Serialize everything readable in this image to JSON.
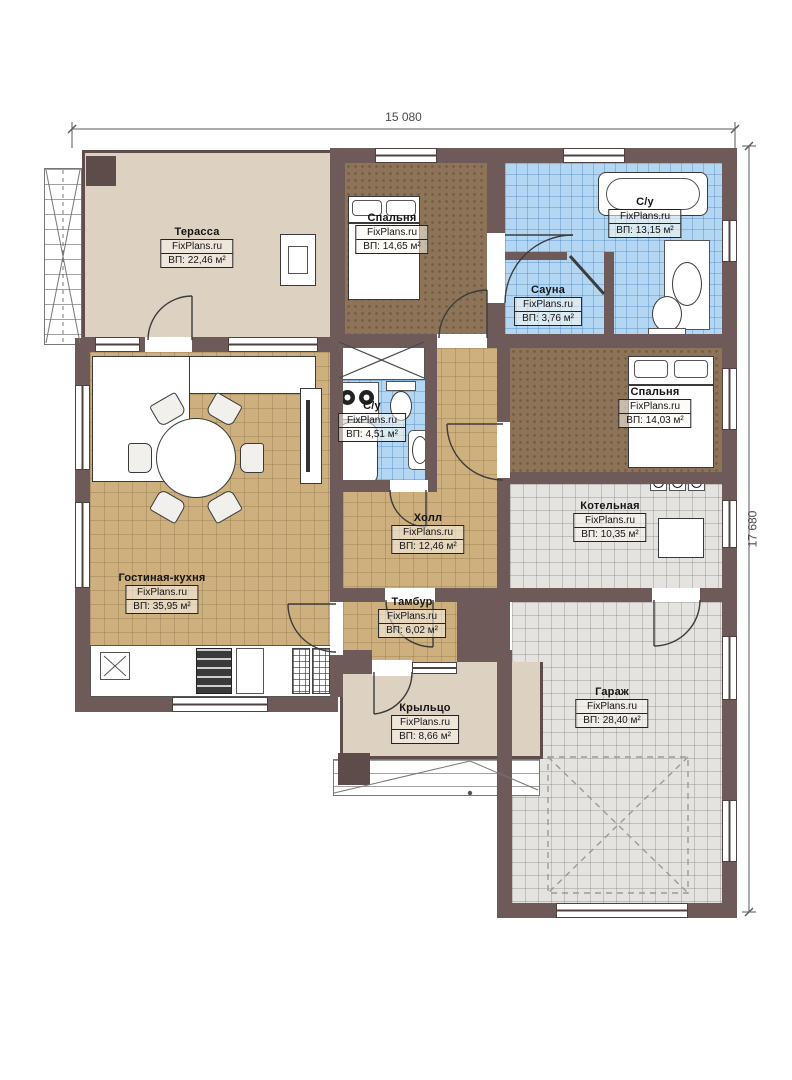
{
  "plan": {
    "dimensions": {
      "width_label": "15 080",
      "height_label": "17 680"
    },
    "watermark": "FixPlans.ru",
    "rooms": [
      {
        "name": "Терасса",
        "area": "ВП: 22,46 м²"
      },
      {
        "name": "Спальня",
        "area": "ВП: 14,65 м²"
      },
      {
        "name": "С/у",
        "area": "ВП: 13,15 м²"
      },
      {
        "name": "Сауна",
        "area": "ВП: 3,76 м²"
      },
      {
        "name": "Спальня",
        "area": "ВП: 14,03 м²"
      },
      {
        "name": "С/у",
        "area": "ВП: 4,51 м²"
      },
      {
        "name": "Холл",
        "area": "ВП: 12,46 м²"
      },
      {
        "name": "Котельная",
        "area": "ВП: 10,35 м²"
      },
      {
        "name": "Гостиная-кухня",
        "area": "ВП: 35,95 м²"
      },
      {
        "name": "Тамбур",
        "area": "ВП: 6,02 м²"
      },
      {
        "name": "Крыльцо",
        "area": "ВП: 8,66 м²"
      },
      {
        "name": "Гараж",
        "area": "ВП: 28,40 м²"
      }
    ]
  }
}
